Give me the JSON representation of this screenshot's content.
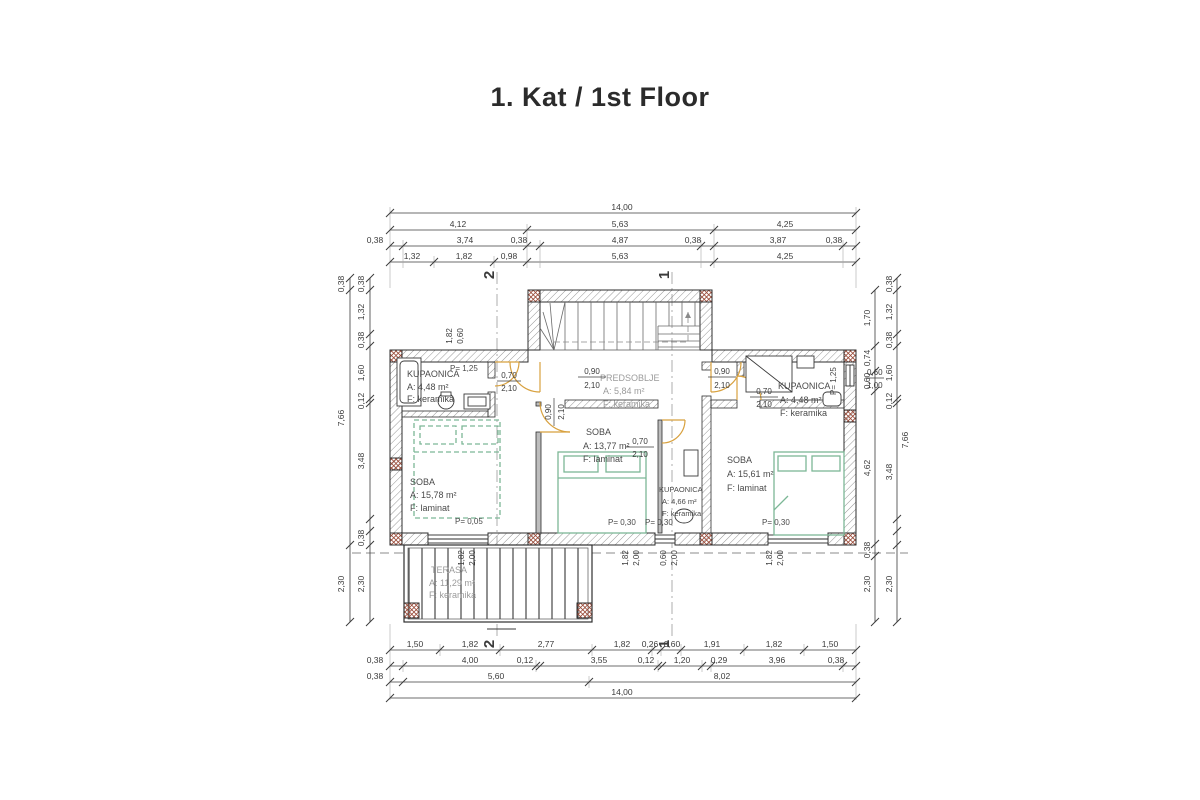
{
  "title": "1. Kat / 1st Floor",
  "colors": {
    "line": "#3b3b3b",
    "wall_hatch": "#7a7a7a",
    "column_accent": "#9a4a38",
    "furniture_green": "#7cb796",
    "door_arc_orange": "#d8a13f",
    "faded_text": "#9b9b9b"
  },
  "rooms": {
    "kupaonica_left": {
      "name": "KUPAONICA",
      "area": "A:   4,48 m²",
      "floor": "F:   keramika",
      "p": "P= 1,25"
    },
    "predsoblje": {
      "name": "PREDSOBLJE",
      "area": "A:   5,84 m²",
      "floor": "F:   keramika"
    },
    "soba_left": {
      "name": "SOBA",
      "area": "A:  15,78 m²",
      "floor": "F:   laminat",
      "p": "P= 0,05"
    },
    "soba_mid": {
      "name": "SOBA",
      "area": "A: 13,77 m²",
      "floor": "F:   laminat",
      "p": "P= 0,30"
    },
    "kupaonica_mid": {
      "name": "KUPAONICA",
      "area": "A: 4,66 m²",
      "floor": "F: keramika",
      "p": "P= 0,30"
    },
    "kupaonica_right": {
      "name": "KUPAONICA",
      "area": "A:   4,48 m²",
      "floor": "F:   keramika",
      "p": "P= 1,25"
    },
    "soba_right": {
      "name": "SOBA",
      "area": "A: 15,61 m²",
      "floor": "F:   laminat",
      "p": "P= 0,30"
    },
    "terasa": {
      "name": "TERASA",
      "area": "A: 11,29 m²",
      "floor": "F: keramika"
    }
  },
  "openings": {
    "door_070_210": {
      "w": "0,70",
      "h": "2,10"
    },
    "door_090_210": {
      "w": "0,90",
      "h": "2,10"
    },
    "win_182_200": {
      "w": "1,82",
      "h": "2,00"
    },
    "win_060_200": {
      "w": "0,60",
      "h": "2,00"
    },
    "win_060_100": {
      "w": "0,60",
      "h": "1,00"
    },
    "win_182_060": {
      "w": "1,82",
      "h": "0,60"
    }
  },
  "sections": {
    "s1": "1",
    "s2": "2"
  },
  "dims": {
    "top1": [
      "14,00"
    ],
    "top2": [
      "4,12",
      "5,63",
      "4,25"
    ],
    "top3": [
      "0,38",
      "3,74",
      "0,38",
      "4,87",
      "0,38",
      "3,87",
      "0,38"
    ],
    "top4": [
      "1,32",
      "1,82",
      "0,98",
      "5,63",
      "4,25"
    ],
    "bottom1": [
      "1,50",
      "1,82",
      "2,77",
      "1,82",
      "0,26",
      "0,60",
      "1,91",
      "1,82",
      "1,50"
    ],
    "bottom2": [
      "0,38",
      "4,00",
      "0,12",
      "3,55",
      "0,12",
      "1,20",
      "0,29",
      "3,96",
      "0,38"
    ],
    "bottom3": [
      "0,38",
      "5,60",
      "8,02"
    ],
    "bottom4": [
      "14,00"
    ],
    "left_outer": [
      "0,38",
      "7,66",
      "2,30"
    ],
    "left_inner": [
      "0,38",
      "1,32",
      "0,38",
      "1,60",
      "0,12",
      "3,48",
      "0,38",
      "2,30"
    ],
    "right_inner": [
      "1,70",
      "0,74",
      "0,60",
      "4,62",
      "0,38",
      "2,30"
    ],
    "right_outer": [
      "0,38",
      "1,32",
      "0,38",
      "1,60",
      "0,12",
      "7,66",
      "3,48",
      "2,30"
    ]
  }
}
